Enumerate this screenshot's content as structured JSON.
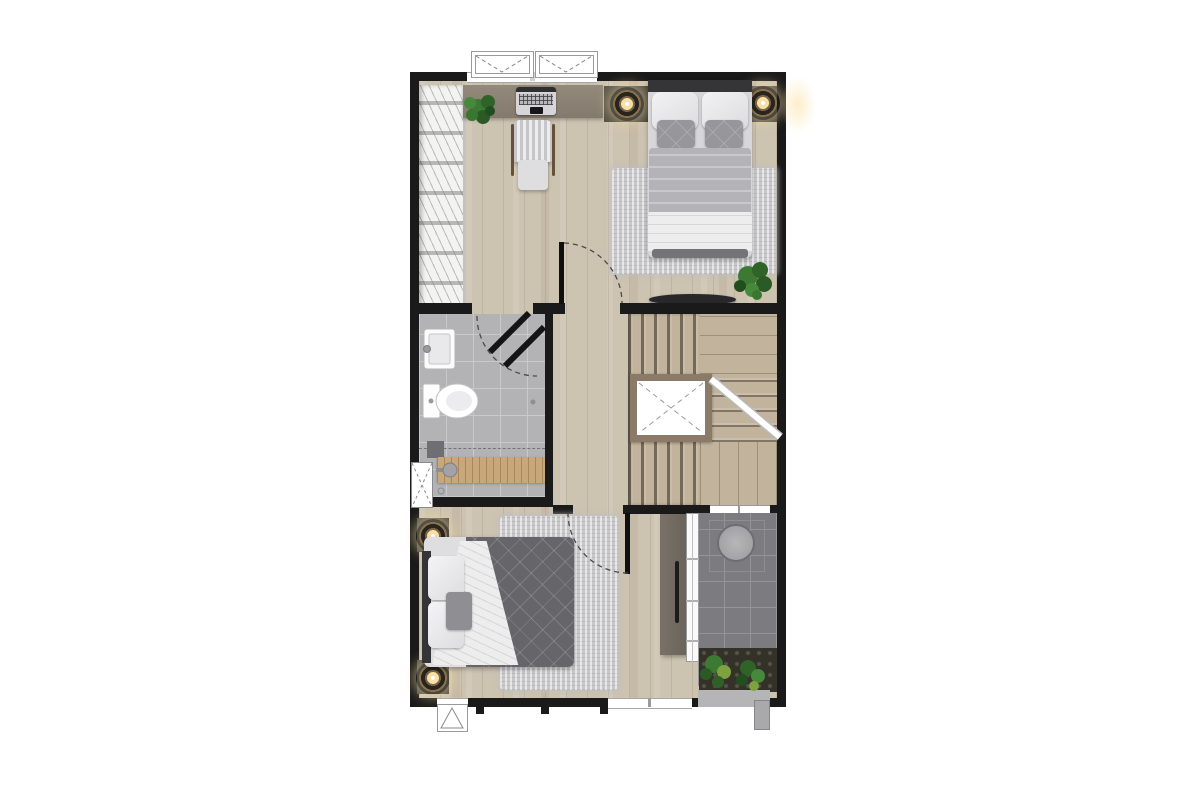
{
  "palette": {
    "wall": "#1a1a1a",
    "wood": "#cdc3b1",
    "bath_tile": "#b3b3b6",
    "grout": "#c9c9cc",
    "balcony_tile": "#7c7c80",
    "balcony_line": "#94949a",
    "desk_wood": "#8b8276",
    "stair_wood": "#c2b49c",
    "void_frame": "#8a7a67",
    "rug": "#c9c9cb",
    "master_blanket": "#b4b4b8",
    "bed2_blanket": "#66666a",
    "duvet": "#ededee",
    "headboard": "#353537",
    "lamp_gold": "#8a7148",
    "lamp_glow": "#f7dfa8",
    "plant_green": "#3c7a33",
    "plant_dark": "#275222",
    "console_wood": "#6f675d",
    "washer_gray": "#a6a6a9",
    "closet_white": "#f3f3f1",
    "ledge_gray": "#b5b5b7"
  },
  "floorplan": {
    "type": "residential-floor-plan-top-view",
    "rooms": [
      {
        "name": "master-bedroom",
        "features": [
          "wardrobe",
          "desk",
          "desk-plant",
          "laptop",
          "office-chair",
          "nightstand-left",
          "wall-lamp-left",
          "nightstand-right",
          "wall-lamp-right",
          "double-bed",
          "area-rug",
          "bench",
          "floor-plant",
          "entry-door"
        ]
      },
      {
        "name": "bathroom",
        "features": [
          "washbasin",
          "toilet",
          "bath-mat",
          "shower-duckboard",
          "shower-mixer",
          "floor-drain",
          "entry-door",
          "service-shaft"
        ]
      },
      {
        "name": "hallway",
        "features": []
      },
      {
        "name": "staircase",
        "features": [
          "lower-flight",
          "upper-flight",
          "landing",
          "stair-void",
          "handrail"
        ]
      },
      {
        "name": "bedroom-2",
        "features": [
          "nightstand-top",
          "wall-lamp-top",
          "nightstand-bottom",
          "wall-lamp-bottom",
          "double-bed",
          "area-rug",
          "wardrobe-console",
          "entry-door"
        ]
      },
      {
        "name": "balcony",
        "features": [
          "sliding-door",
          "washing-machine",
          "planter-plants",
          "ledge",
          "floor-drain"
        ]
      }
    ],
    "window_counts": {
      "top_casement": 2,
      "bottom_awning_symbol": 1,
      "bedroom2_bottom": 2,
      "balcony_wall": 1
    }
  }
}
